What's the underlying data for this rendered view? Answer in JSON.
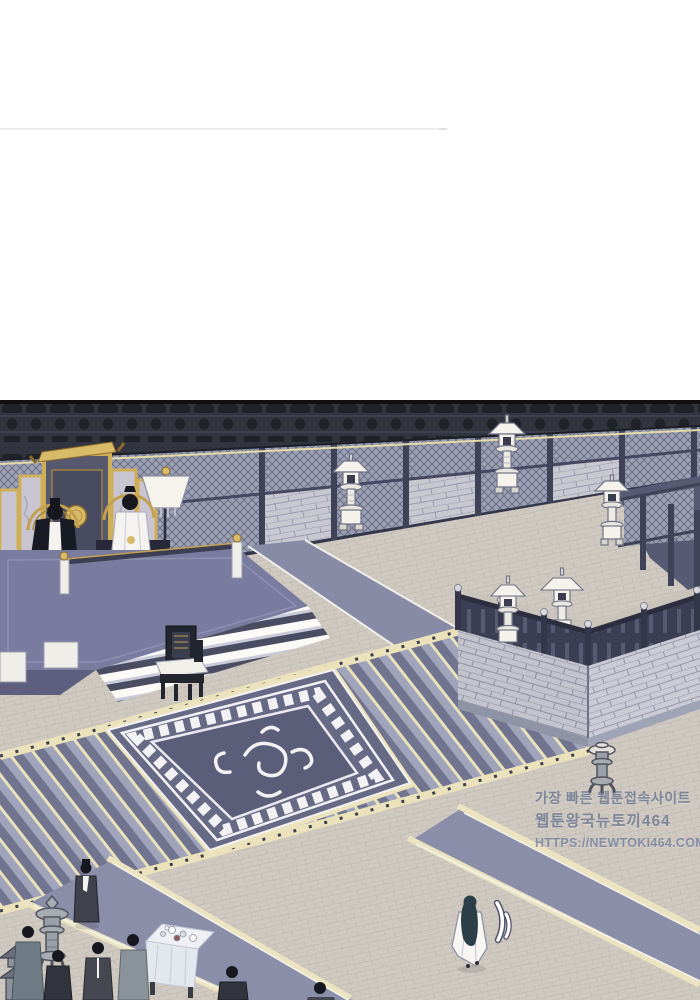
{
  "watermark": {
    "line1": "가장 빠른 웹툰접속사이트",
    "line2": "웹툰왕국뉴토끼464",
    "line3": "HTTPS://NEWTOKI464.COM"
  },
  "palette": {
    "page_background": "#ffffff",
    "divider": "#ededed",
    "panel_border": "#101013",
    "wall_wood": "#565a72",
    "frieze_dark": "#32343f",
    "brick": "#c8c8d1",
    "lattice": "#9ca0b4",
    "floor_tile": "#cfc9c1",
    "carpet_blue": "#8a8ea9",
    "dais_carpet": "#797c9e",
    "gold_trim": "#d8bb69",
    "cream_stone": "#ece4c0",
    "slab_dark": "#666a85",
    "lantern_white": "#f4f2ea",
    "bronze": "#a7abb2",
    "robe_white": "#f7f6f2",
    "robe_dark": "#31343c",
    "hair_black": "#17181f",
    "watermark_blue": "#3e5076"
  },
  "scene_elements": [
    "throne-screen",
    "emperor-figure",
    "empress-figure",
    "canopy-lamp",
    "dais-steps",
    "palace-chair",
    "stone-lantern",
    "grand-stairway",
    "relief-slab",
    "terrace",
    "terrace-balustrade",
    "bronze-censer",
    "carpet-runner",
    "officials-group",
    "tea-table",
    "walking-figure",
    "motion-lines",
    "pagoda-model"
  ]
}
